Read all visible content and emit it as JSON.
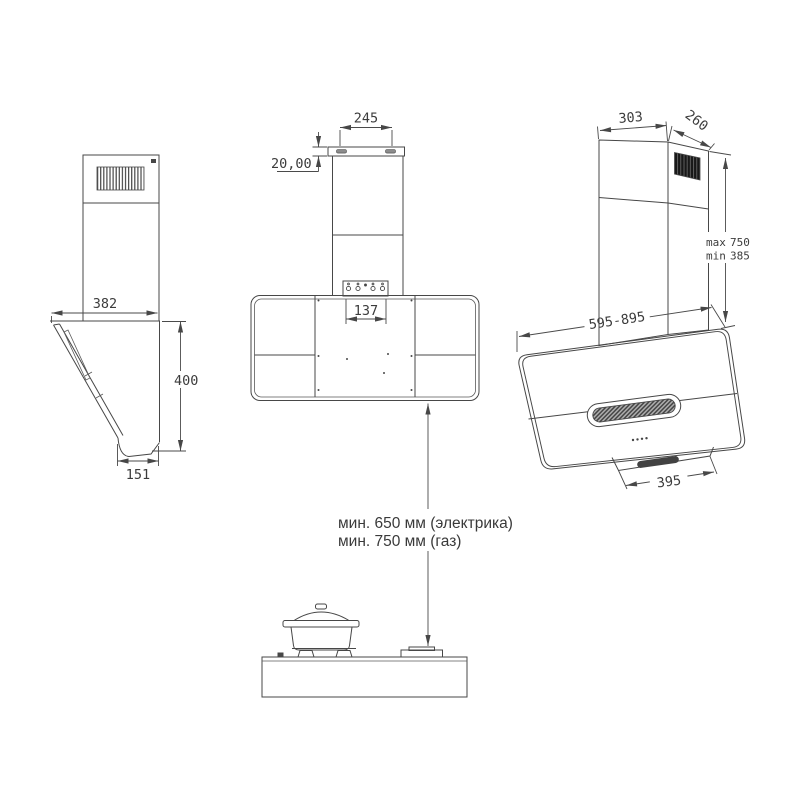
{
  "page": {
    "background": "#ffffff",
    "line_color": "#474747",
    "text_color": "#3c3c3c",
    "grille_color": "#181818",
    "hatch_color": "#424242"
  },
  "side_view": {
    "dim_width": "382",
    "dim_height": "400",
    "dim_foot_depth": "151"
  },
  "front_view": {
    "dim_bracket_span": "245",
    "dim_bracket_height": "20,00",
    "dim_duct_offset": "137"
  },
  "iso_view": {
    "dim_chimney_width": "303",
    "dim_chimney_depth": "260",
    "dim_height_max_label": "max",
    "dim_height_max_value": "750",
    "dim_height_min_label": "min",
    "dim_height_min_value": "385",
    "dim_body_width_range": "595-895",
    "dim_base_width": "395"
  },
  "installation": {
    "clearance_electric": "мин. 650 мм (электрика)",
    "clearance_gas": "мин. 750 мм (газ)"
  }
}
